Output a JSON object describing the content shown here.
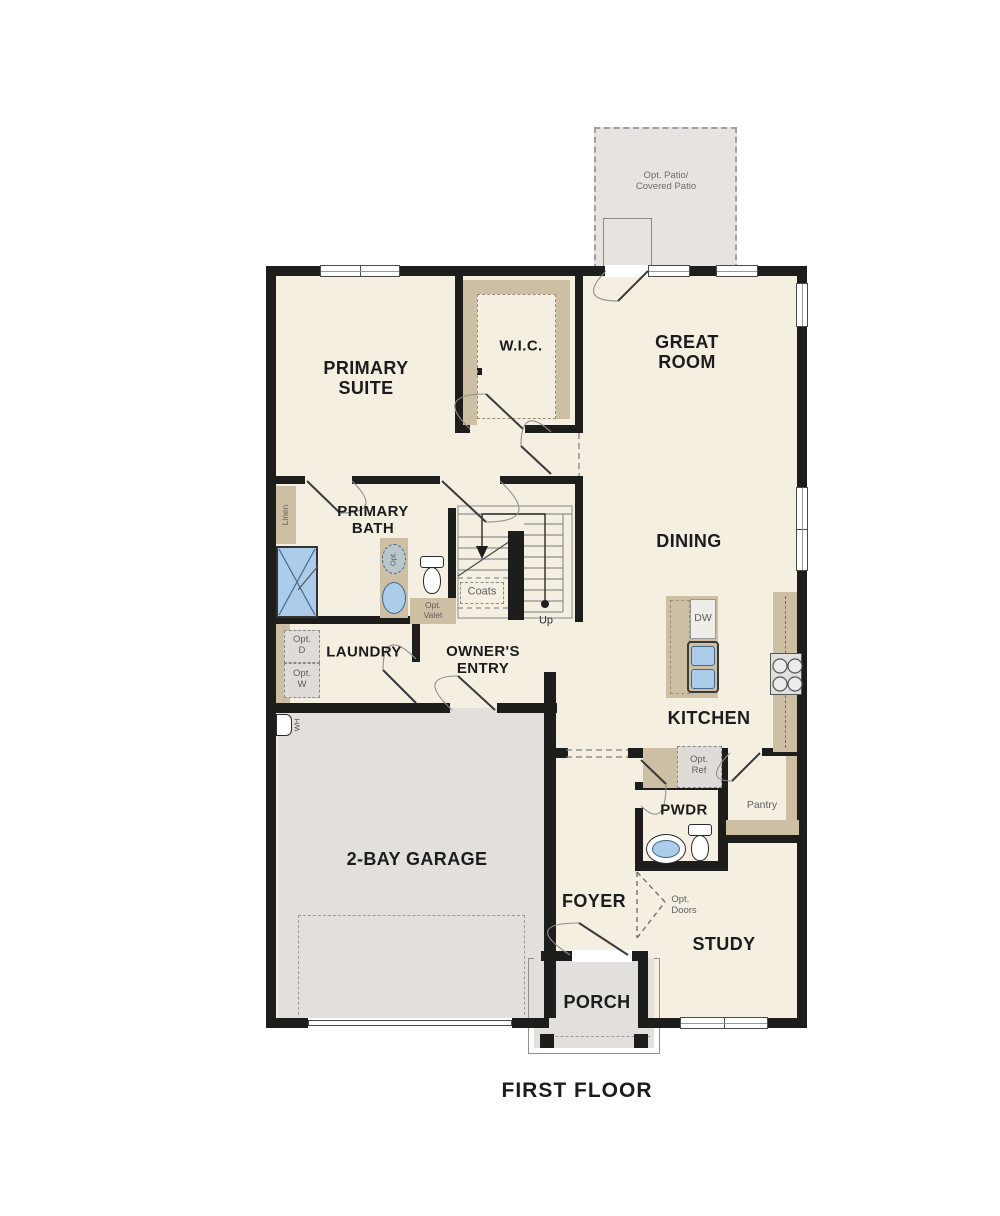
{
  "title": "FIRST FLOOR",
  "labels": {
    "patio": "Opt. Patio/\nCovered Patio",
    "primary_suite": "PRIMARY\nSUITE",
    "wic": "W.I.C.",
    "great_room": "GREAT\nROOM",
    "primary_bath": "PRIMARY\nBATH",
    "dining": "DINING",
    "laundry": "LAUNDRY",
    "owners_entry": "OWNER'S\nENTRY",
    "kitchen": "KITCHEN",
    "garage": "2-BAY GARAGE",
    "pwdr": "PWDR",
    "foyer": "FOYER",
    "study": "STUDY",
    "porch": "PORCH",
    "floor_title": "FIRST FLOOR",
    "linen": "Linen",
    "coats": "Coats",
    "up": "Up",
    "opt_sink": "Opt.",
    "opt_valet": "Opt.\nValet",
    "opt_dryer": "Opt.\nD",
    "opt_washer": "Opt.\nW",
    "water_heater": "WH",
    "dishwasher": "DW",
    "opt_ref": "Opt.\nRef",
    "pantry": "Pantry",
    "opt_doors": "Opt.\nDoors"
  },
  "colors": {
    "wall": "#1d1d1b",
    "room": "#f5efe2",
    "hard": "#e3e0db",
    "patio": "#e7e4df",
    "tan": "#cdbfa4",
    "tanline": "#9a8d74",
    "blue": "#abcdea",
    "blueb": "#44688c",
    "line": "#8f8f8f",
    "ink": "#1c1c1c",
    "muted": "#5f5f5f",
    "boxfill": "#dfdcd7"
  }
}
